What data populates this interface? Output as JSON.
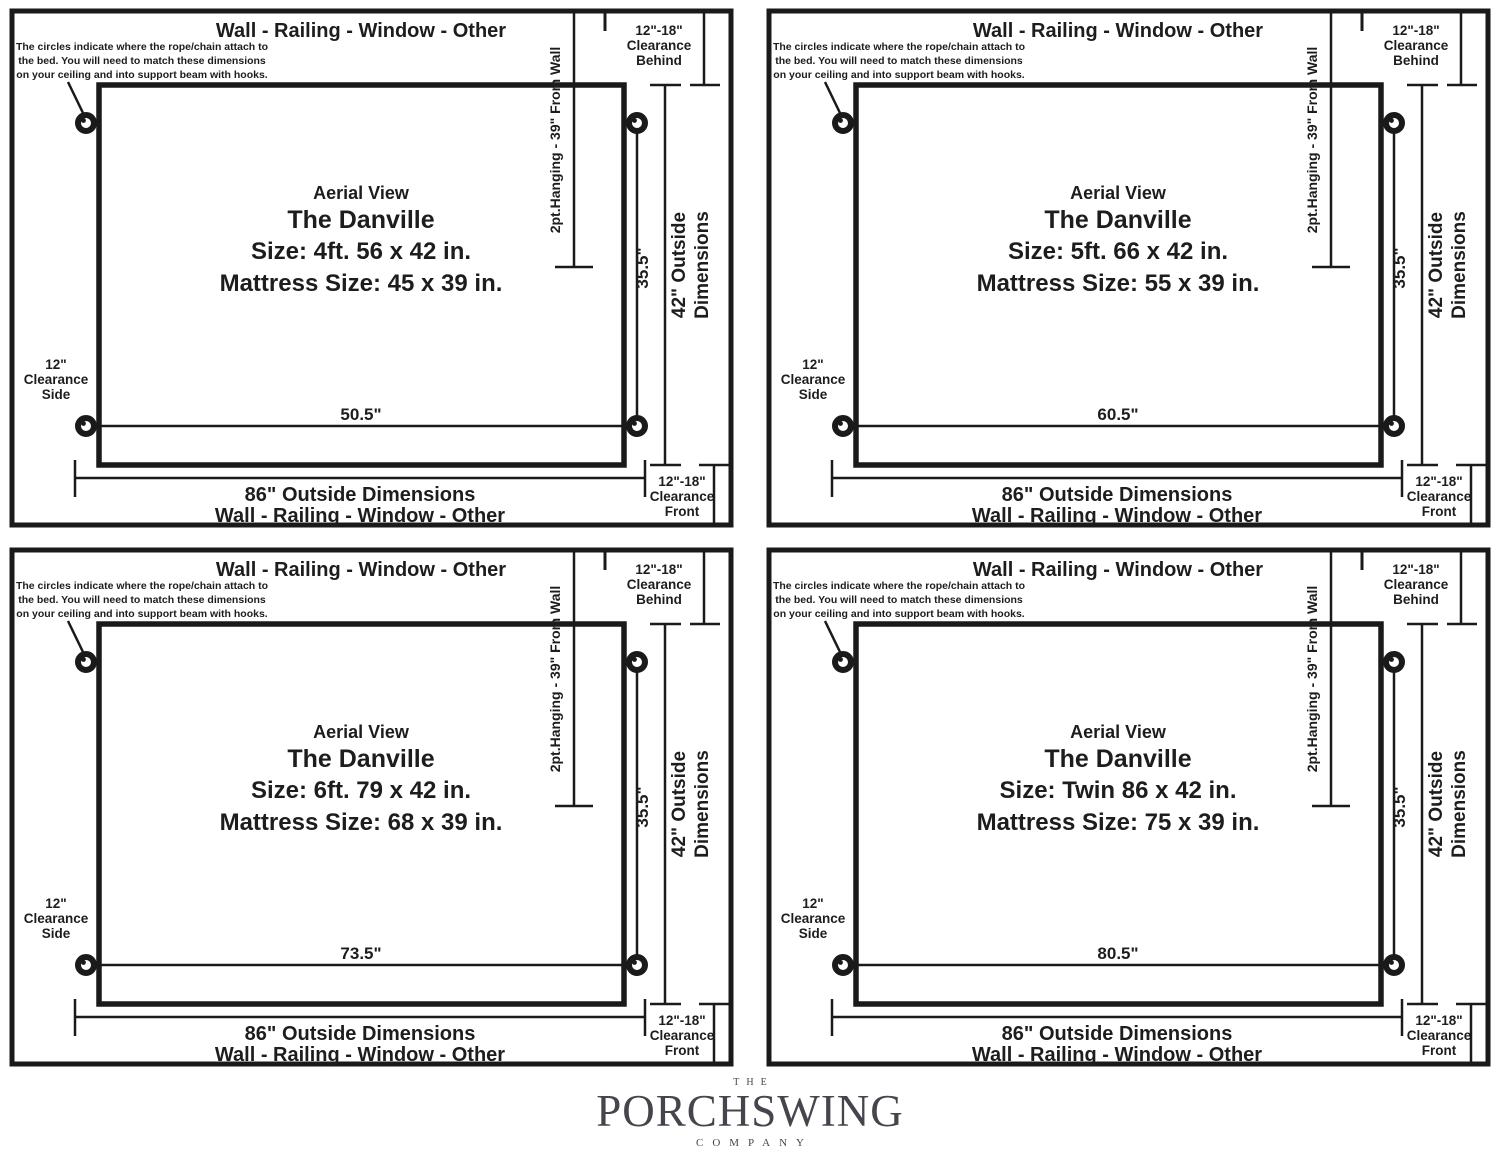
{
  "common": {
    "wall_label": "Wall - Railing - Window - Other",
    "note_line1": "The circles indicate where the rope/chain attach to",
    "note_line2": "the bed. You will need to match these dimensions",
    "note_line3": "on your ceiling and into support beam with hooks.",
    "clearance_behind_l1": "12\"-18\"",
    "clearance_behind_l2": "Clearance",
    "clearance_behind_l3": "Behind",
    "clearance_front_l1": "12\"-18\"",
    "clearance_front_l2": "Clearance",
    "clearance_front_l3": "Front",
    "clearance_side_l1": "12\"",
    "clearance_side_l2": "Clearance",
    "clearance_side_l3": "Side",
    "hanging_label": "2pt.Hanging - 39\" From Wall",
    "attach_span_depth": "35.5\"",
    "outside_depth_l1": "42\" Outside",
    "outside_depth_l2": "Dimensions",
    "aerial_label": "Aerial View",
    "model_name": "The Danville",
    "outside_width_label": "86\" Outside Dimensions",
    "colors": {
      "line": "#1a1a1a",
      "model_name": "#b7ba90",
      "logo": "#45454e"
    }
  },
  "panels": [
    {
      "size_label": "Size: 4ft. 56 x 42 in.",
      "mattress_label": "Mattress Size: 45 x 39 in.",
      "attach_span_width": "50.5\""
    },
    {
      "size_label": "Size: 5ft. 66 x 42 in.",
      "mattress_label": "Mattress Size: 55 x 39 in.",
      "attach_span_width": "60.5\""
    },
    {
      "size_label": "Size: 6ft. 79 x 42 in.",
      "mattress_label": "Mattress Size: 68 x 39 in.",
      "attach_span_width": "73.5\""
    },
    {
      "size_label": "Size: Twin 86 x 42 in.",
      "mattress_label": "Mattress Size: 75 x 39 in.",
      "attach_span_width": "80.5\""
    }
  ],
  "footer": {
    "the_label": "THE",
    "name_label": "PORCHSWING",
    "company_label": "COMPANY"
  }
}
